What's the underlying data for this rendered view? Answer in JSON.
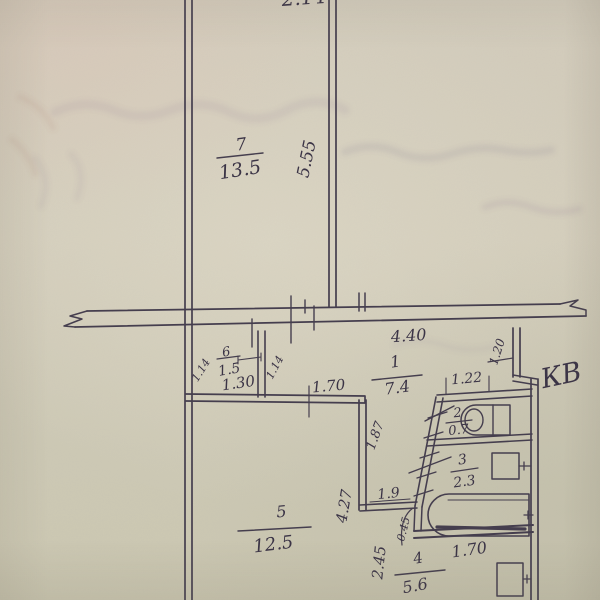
{
  "document": {
    "kind": "scanned hand-drawn apartment floor plan (BTI sheet)",
    "annotations": {
      "apartment_label": "КВ",
      "partial_top_dimension": "2.14"
    }
  },
  "plan": {
    "rooms": {
      "living_top": {
        "number": "7",
        "area": "13.5"
      },
      "closet": {
        "number": "6",
        "area": "1.5"
      },
      "hall": {
        "number": "1",
        "area": "7.4"
      },
      "toilet": {
        "number": "2",
        "area": "0.7"
      },
      "bathroom": {
        "number": "3",
        "area": "2.3"
      },
      "living_bottom": {
        "number": "5",
        "area": "12.5"
      },
      "kitchen": {
        "number": "4",
        "area": "5.6"
      }
    },
    "dimensions": {
      "living_top_length": "5.55",
      "corridor_width": "4.40",
      "closet_side_left": "1.14",
      "closet_side_right": "1.14",
      "closet_width": "1.30",
      "living_bottom_top_edge": "1.70",
      "hall_depth": "1.87",
      "toilet_width": "1.22",
      "entry_width": "1.20",
      "living_bottom_height": "4.27",
      "passage_width": "1.9",
      "door_leaf": "0.45",
      "kitchen_edge": "2.45",
      "bath_length": "1.70"
    }
  },
  "colors": {
    "paper": "#d2ccba",
    "ink": "#453e4e"
  }
}
